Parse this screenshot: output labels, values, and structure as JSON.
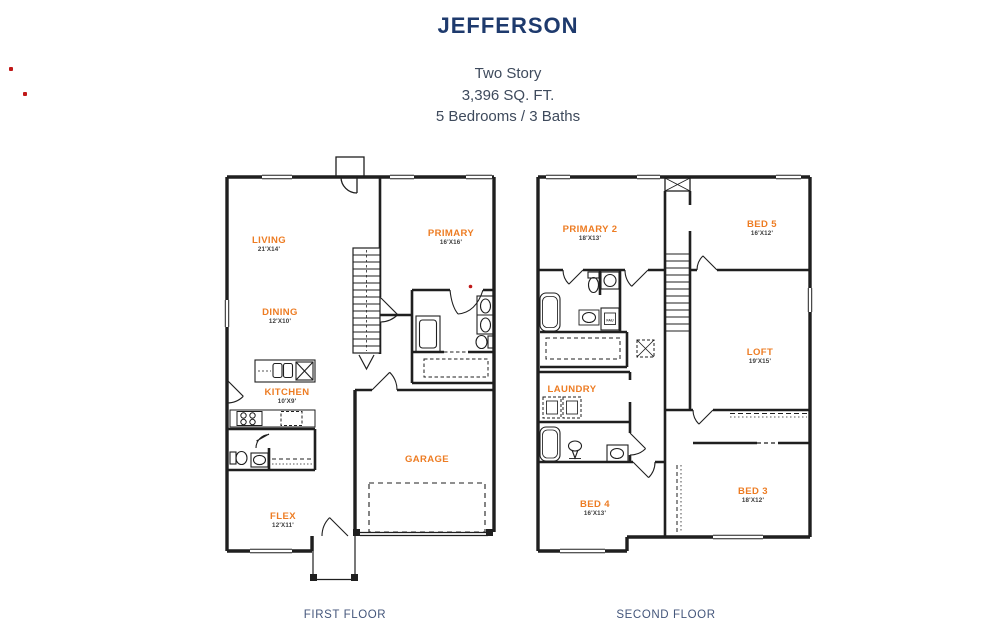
{
  "header": {
    "title": "JEFFERSON",
    "subtitle_line1": "Two Story",
    "subtitle_line2": "3,396 SQ. FT.",
    "subtitle_line3": "5 Bedrooms / 3 Baths"
  },
  "colors": {
    "title_navy": "#1E3A6D",
    "subtitle_gray": "#3E4A5C",
    "room_label_orange": "#ED7C23",
    "dimension_gray": "#3C3C3C",
    "caption_blue": "#44567B",
    "wall_black": "#1F1F1F",
    "marker_red": "#C01818"
  },
  "first_floor": {
    "caption": "FIRST FLOOR",
    "rooms": {
      "living": {
        "name": "LIVING",
        "dims": "21'X14'"
      },
      "dining": {
        "name": "DINING",
        "dims": "12'X10'"
      },
      "kitchen": {
        "name": "KITCHEN",
        "dims": "10'X9'"
      },
      "flex": {
        "name": "FLEX",
        "dims": "12'X11'"
      },
      "garage": {
        "name": "GARAGE"
      },
      "primary": {
        "name": "PRIMARY",
        "dims": "16'X16'"
      }
    }
  },
  "second_floor": {
    "caption": "SECOND FLOOR",
    "fau_label": "FAU",
    "rooms": {
      "primary2": {
        "name": "PRIMARY 2",
        "dims": "18'X13'"
      },
      "bed5": {
        "name": "BED 5",
        "dims": "16'X12'"
      },
      "loft": {
        "name": "LOFT",
        "dims": "19'X15'"
      },
      "laundry": {
        "name": "LAUNDRY"
      },
      "bed4": {
        "name": "BED 4",
        "dims": "16'X13'"
      },
      "bed3": {
        "name": "BED 3",
        "dims": "18'X12'"
      }
    }
  }
}
